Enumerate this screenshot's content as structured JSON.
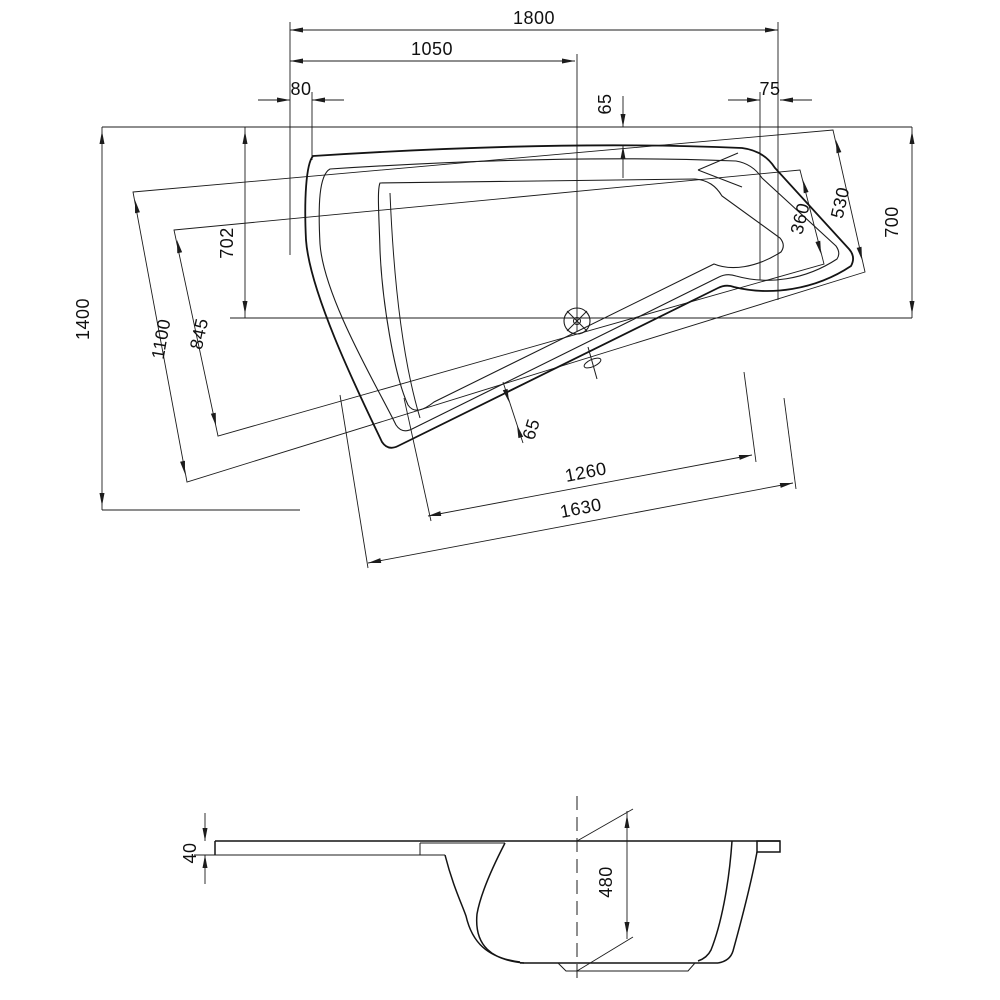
{
  "drawing": {
    "dims": {
      "overall_length": "1800",
      "length_to_drain": "1050",
      "corner_offset_left": "80",
      "corner_offset_right": "75",
      "rim_edge_top": "65",
      "depth_at_drain": "702",
      "overall_width": "1400",
      "basin_side_foot": "845",
      "shell_side_foot": "1100",
      "shell_side_head": "530",
      "basin_side_head": "360",
      "side_right": "700",
      "rim_edge_slant": "65",
      "basin_length": "1260",
      "shell_length": "1630",
      "rim_height": "40",
      "tub_depth": "480"
    }
  }
}
